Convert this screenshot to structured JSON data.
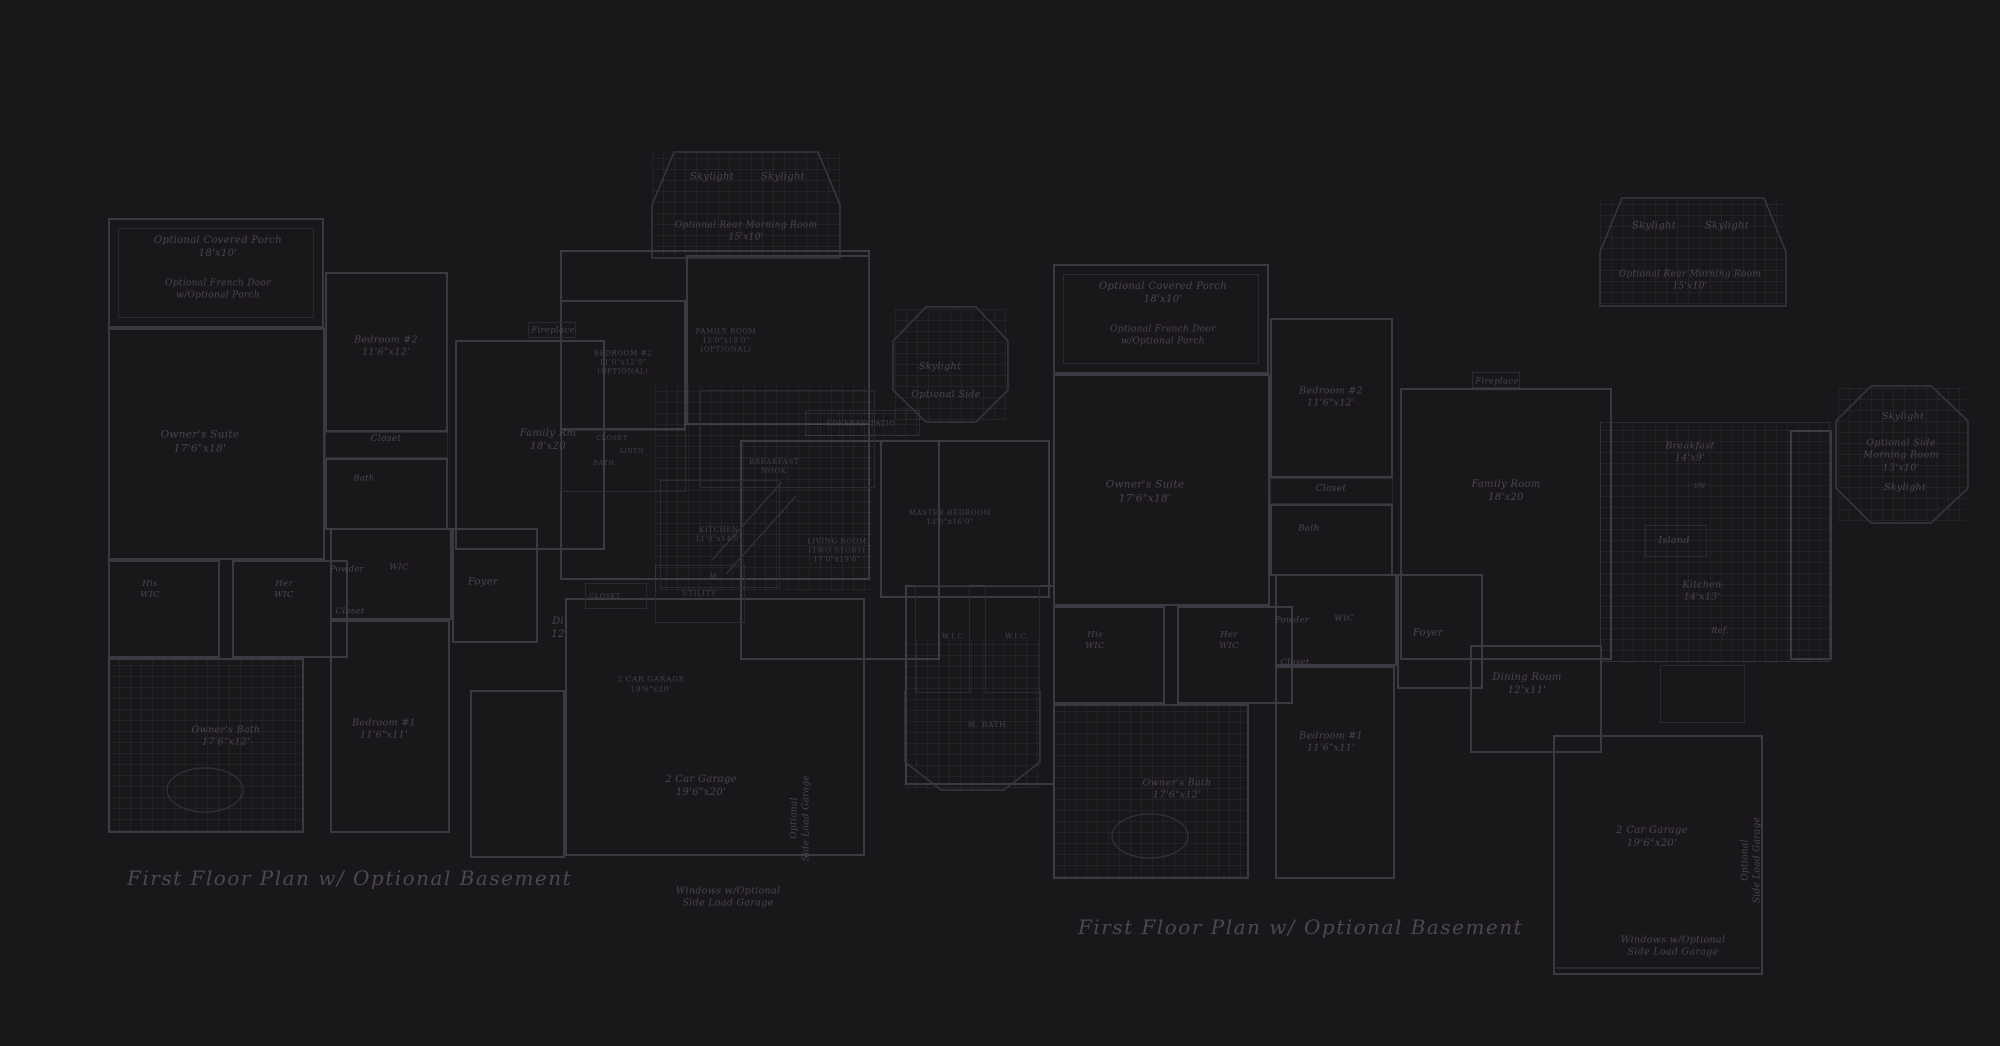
{
  "canvas": {
    "width": 2000,
    "height": 1046,
    "background": "#1a171a",
    "wall_color": "#3b3942",
    "faint_color": "#2b2931",
    "text_color": "#49464f",
    "title_color": "#4b4852"
  },
  "titles": {
    "left": "First Floor Plan  w/ Optional Basement",
    "right": "First Floor Plan  w/ Optional Basement"
  },
  "labels": [
    {
      "n": "label-optional-covered-porch-left",
      "l": [
        "Optional Covered Porch",
        "18'x10'"
      ],
      "x": 218,
      "y": 247,
      "fs": 10
    },
    {
      "n": "label-optional-french-door-left",
      "l": [
        "Optional French Door",
        "w/Optional Porch"
      ],
      "x": 218,
      "y": 290,
      "fs": 9
    },
    {
      "n": "label-bedroom2-left",
      "l": [
        "Bedroom #2",
        "11'6\"x12'"
      ],
      "x": 386,
      "y": 347,
      "fs": 9.5
    },
    {
      "n": "label-closet-bedroom2-left",
      "l": [
        "Closet"
      ],
      "x": 386,
      "y": 440,
      "fs": 9
    },
    {
      "n": "label-bath-left",
      "l": [
        "Bath"
      ],
      "x": 364,
      "y": 479,
      "fs": 8.5
    },
    {
      "n": "label-owners-suite-left",
      "l": [
        "Owner's Suite",
        "17'6\"x18'"
      ],
      "x": 200,
      "y": 442,
      "fs": 10.5
    },
    {
      "n": "label-his-wic-left",
      "l": [
        "His",
        "WIC"
      ],
      "x": 150,
      "y": 590,
      "fs": 8.5
    },
    {
      "n": "label-her-wic-left",
      "l": [
        "Her",
        "WIC"
      ],
      "x": 284,
      "y": 590,
      "fs": 8.5
    },
    {
      "n": "label-powder-left",
      "l": [
        "Powder"
      ],
      "x": 347,
      "y": 570,
      "fs": 8.5
    },
    {
      "n": "label-wic-left",
      "l": [
        "WIC"
      ],
      "x": 399,
      "y": 568,
      "fs": 8.5
    },
    {
      "n": "label-closet-hall-left",
      "l": [
        "Closet"
      ],
      "x": 350,
      "y": 612,
      "fs": 8.5
    },
    {
      "n": "label-foyer-left",
      "l": [
        "Foyer"
      ],
      "x": 483,
      "y": 582,
      "fs": 10
    },
    {
      "n": "label-dining-left",
      "l": [
        "Di",
        "12"
      ],
      "x": 558,
      "y": 628,
      "fs": 10
    },
    {
      "n": "label-bedroom1-left",
      "l": [
        "Bedroom #1",
        "11'6\"x11'"
      ],
      "x": 384,
      "y": 730,
      "fs": 9.5
    },
    {
      "n": "label-owners-bath-left",
      "l": [
        "Owner's Bath",
        "17'6\"x12'"
      ],
      "x": 226,
      "y": 737,
      "fs": 9.5
    },
    {
      "n": "label-skylight-1-left",
      "l": [
        "Skylight"
      ],
      "x": 712,
      "y": 177,
      "fs": 10
    },
    {
      "n": "label-skylight-2-left",
      "l": [
        "Skylight"
      ],
      "x": 783,
      "y": 177,
      "fs": 10
    },
    {
      "n": "label-optional-rear-morning-room-left",
      "l": [
        "Optional Rear Morning Room",
        "15'x10'"
      ],
      "x": 746,
      "y": 232,
      "fs": 9
    },
    {
      "n": "label-fireplace-left",
      "l": [
        "Fireplace"
      ],
      "x": 553,
      "y": 331,
      "fs": 8.5
    },
    {
      "n": "label-family-rm-left",
      "l": [
        "Family Rm",
        "18'x20"
      ],
      "x": 548,
      "y": 440,
      "fs": 10
    },
    {
      "n": "label-skylight-side-left",
      "l": [
        "Skylight"
      ],
      "x": 940,
      "y": 367,
      "fs": 9.5
    },
    {
      "n": "label-optional-side-left",
      "l": [
        "Optional Side"
      ],
      "x": 946,
      "y": 395,
      "fs": 9.5
    },
    {
      "n": "label-2-car-garage-left",
      "l": [
        "2 Car Garage",
        "19'6\"x20'"
      ],
      "x": 701,
      "y": 786,
      "fs": 10
    },
    {
      "n": "label-optional-side-load-garage-left",
      "l": [
        "Optional",
        "Side Load Garage"
      ],
      "x": 801,
      "y": 818,
      "fs": 9,
      "rot": -90
    },
    {
      "n": "label-windows-optional-side-load-left",
      "l": [
        "Windows w/Optional",
        "Side Load Garage"
      ],
      "x": 728,
      "y": 898,
      "fs": 9.5
    },
    {
      "n": "label-washer-left",
      "l": [
        "W"
      ],
      "x": 714,
      "y": 577,
      "fs": 7,
      "st": "c"
    },
    {
      "n": "label-caps-bedroom-center",
      "l": [
        "BEDROOM #2",
        "11'0\"x12'0\"",
        "(OPTIONAL)"
      ],
      "x": 623,
      "y": 363,
      "fs": 7,
      "st": "c"
    },
    {
      "n": "label-caps-family-room-center",
      "l": [
        "FAMILY ROOM",
        "15'0\"x18'0\"",
        "(OPTIONAL)"
      ],
      "x": 726,
      "y": 341,
      "fs": 7,
      "st": "c"
    },
    {
      "n": "label-caps-closet-center",
      "l": [
        "CLOSET"
      ],
      "x": 612,
      "y": 438,
      "fs": 6.5,
      "st": "c"
    },
    {
      "n": "label-caps-linen-center",
      "l": [
        "LINEN"
      ],
      "x": 632,
      "y": 452,
      "fs": 6,
      "st": "c"
    },
    {
      "n": "label-caps-bath-center",
      "l": [
        "BATH"
      ],
      "x": 604,
      "y": 463,
      "fs": 6.5,
      "st": "c"
    },
    {
      "n": "label-caps-breakfast-nook-center",
      "l": [
        "BREAKFAST",
        "NOOK"
      ],
      "x": 774,
      "y": 467,
      "fs": 7,
      "st": "c"
    },
    {
      "n": "label-caps-kitchen-center",
      "l": [
        "KITCHEN",
        "11'0\"x14'0\""
      ],
      "x": 719,
      "y": 535,
      "fs": 7,
      "st": "c"
    },
    {
      "n": "label-caps-living-room-center",
      "l": [
        "LIVING ROOM",
        "(TWO STORY)",
        "17'0\"x19'0\""
      ],
      "x": 837,
      "y": 551,
      "fs": 7,
      "st": "c"
    },
    {
      "n": "label-caps-master-bedroom-center",
      "l": [
        "MASTER BEDROOM",
        "13'0\"x16'0\""
      ],
      "x": 950,
      "y": 518,
      "fs": 7,
      "st": "c"
    },
    {
      "n": "label-caps-covered-patio-center",
      "l": [
        "COVERED PATIO"
      ],
      "x": 861,
      "y": 424,
      "fs": 7,
      "st": "c"
    },
    {
      "n": "label-caps-utility-center",
      "l": [
        "UTILITY"
      ],
      "x": 699,
      "y": 594,
      "fs": 7,
      "st": "c"
    },
    {
      "n": "label-caps-closet2-center",
      "l": [
        "CLOSET"
      ],
      "x": 605,
      "y": 596,
      "fs": 6.5,
      "st": "c"
    },
    {
      "n": "label-caps-2-car-garage-center",
      "l": [
        "2 CAR GARAGE",
        "19'6\"x20'"
      ],
      "x": 651,
      "y": 684,
      "fs": 7.5,
      "st": "c"
    },
    {
      "n": "label-wic-a-center",
      "l": [
        "W.I.C."
      ],
      "x": 954,
      "y": 637,
      "fs": 7,
      "st": "c"
    },
    {
      "n": "label-wic-b-center",
      "l": [
        "W.I.C."
      ],
      "x": 1017,
      "y": 637,
      "fs": 7,
      "st": "c"
    },
    {
      "n": "label-caps-m-bath-center",
      "l": [
        "M. BATH"
      ],
      "x": 987,
      "y": 725,
      "fs": 7.5,
      "st": "c"
    },
    {
      "n": "label-optional-covered-porch-right",
      "l": [
        "Optional Covered Porch",
        "18'x10'"
      ],
      "x": 1163,
      "y": 293,
      "fs": 10
    },
    {
      "n": "label-optional-french-door-right",
      "l": [
        "Optional French Door",
        "w/Optional Porch"
      ],
      "x": 1163,
      "y": 336,
      "fs": 9
    },
    {
      "n": "label-bedroom2-right",
      "l": [
        "Bedroom #2",
        "11'6\"x12'"
      ],
      "x": 1331,
      "y": 398,
      "fs": 9.5
    },
    {
      "n": "label-closet-bedroom2-right",
      "l": [
        "Closet"
      ],
      "x": 1331,
      "y": 490,
      "fs": 9
    },
    {
      "n": "label-bath-right",
      "l": [
        "Bath"
      ],
      "x": 1309,
      "y": 529,
      "fs": 8.5
    },
    {
      "n": "label-owners-suite-right",
      "l": [
        "Owner's Suite",
        "17'6\"x18'"
      ],
      "x": 1145,
      "y": 492,
      "fs": 10.5
    },
    {
      "n": "label-his-wic-right",
      "l": [
        "His",
        "WIC"
      ],
      "x": 1095,
      "y": 641,
      "fs": 8.5
    },
    {
      "n": "label-her-wic-right",
      "l": [
        "Her",
        "WIC"
      ],
      "x": 1229,
      "y": 641,
      "fs": 8.5
    },
    {
      "n": "label-powder-right",
      "l": [
        "Powder"
      ],
      "x": 1292,
      "y": 621,
      "fs": 8.5
    },
    {
      "n": "label-wic-right",
      "l": [
        "WIC"
      ],
      "x": 1344,
      "y": 619,
      "fs": 8.5
    },
    {
      "n": "label-closet-hall-right",
      "l": [
        "Closet"
      ],
      "x": 1295,
      "y": 663,
      "fs": 8.5
    },
    {
      "n": "label-foyer-right",
      "l": [
        "Foyer"
      ],
      "x": 1428,
      "y": 633,
      "fs": 10
    },
    {
      "n": "label-dining-room-right",
      "l": [
        "Dining Room",
        "12'x11'"
      ],
      "x": 1527,
      "y": 684,
      "fs": 10
    },
    {
      "n": "label-bedroom1-right",
      "l": [
        "Bedroom #1",
        "11'6\"x11'"
      ],
      "x": 1331,
      "y": 743,
      "fs": 9.5
    },
    {
      "n": "label-owners-bath-right",
      "l": [
        "Owner's Bath",
        "17'6\"x12'"
      ],
      "x": 1177,
      "y": 790,
      "fs": 9.5
    },
    {
      "n": "label-skylight-1-right",
      "l": [
        "Skylight"
      ],
      "x": 1654,
      "y": 226,
      "fs": 10
    },
    {
      "n": "label-skylight-2-right",
      "l": [
        "Skylight"
      ],
      "x": 1727,
      "y": 226,
      "fs": 10
    },
    {
      "n": "label-optional-rear-morning-room-right",
      "l": [
        "Optional Rear Morning Room",
        "15'x10'"
      ],
      "x": 1690,
      "y": 281,
      "fs": 9
    },
    {
      "n": "label-fireplace-right",
      "l": [
        "Fireplace"
      ],
      "x": 1497,
      "y": 382,
      "fs": 8.5
    },
    {
      "n": "label-family-room-right",
      "l": [
        "Family Room",
        "18'x20"
      ],
      "x": 1506,
      "y": 491,
      "fs": 10
    },
    {
      "n": "label-breakfast-right",
      "l": [
        "Breakfast",
        "14'x9'"
      ],
      "x": 1690,
      "y": 453,
      "fs": 9.5
    },
    {
      "n": "label-dw-right",
      "l": [
        "DW"
      ],
      "x": 1700,
      "y": 487,
      "fs": 6,
      "st": "c"
    },
    {
      "n": "label-island-right",
      "l": [
        "Island"
      ],
      "x": 1674,
      "y": 541,
      "fs": 9.5
    },
    {
      "n": "label-kitchen-right",
      "l": [
        "Kitchen",
        "14'x13'"
      ],
      "x": 1702,
      "y": 592,
      "fs": 9.5
    },
    {
      "n": "label-ref-right",
      "l": [
        "Ref."
      ],
      "x": 1720,
      "y": 631,
      "fs": 8
    },
    {
      "n": "label-skylight-side-top-right",
      "l": [
        "Skylight"
      ],
      "x": 1903,
      "y": 417,
      "fs": 9.5
    },
    {
      "n": "label-optional-side-morning-room-right",
      "l": [
        "Optional Side",
        "Morning Room",
        "13'x10'"
      ],
      "x": 1901,
      "y": 456,
      "fs": 9.5
    },
    {
      "n": "label-skylight-side-bottom-right",
      "l": [
        "Skylight"
      ],
      "x": 1905,
      "y": 488,
      "fs": 9.5
    },
    {
      "n": "label-2-car-garage-right",
      "l": [
        "2 Car Garage",
        "19'6\"x20'"
      ],
      "x": 1652,
      "y": 837,
      "fs": 10
    },
    {
      "n": "label-optional-side-load-garage-right",
      "l": [
        "Optional",
        "Side Load Garage"
      ],
      "x": 1752,
      "y": 860,
      "fs": 9,
      "rot": -90
    },
    {
      "n": "label-windows-optional-side-load-right",
      "l": [
        "Windows w/Optional",
        "Side Load Garage"
      ],
      "x": 1673,
      "y": 947,
      "fs": 9.5
    }
  ],
  "walls": [
    [
      108,
      218,
      216,
      110
    ],
    [
      108,
      328,
      217,
      232
    ],
    [
      325,
      272,
      123,
      160
    ],
    [
      325,
      458,
      123,
      72
    ],
    [
      108,
      560,
      112,
      98
    ],
    [
      232,
      560,
      116,
      98
    ],
    [
      108,
      658,
      196,
      175
    ],
    [
      330,
      620,
      120,
      213
    ],
    [
      330,
      528,
      122,
      92
    ],
    [
      452,
      528,
      86,
      115
    ],
    [
      455,
      340,
      150,
      210
    ],
    [
      560,
      250,
      310,
      330
    ],
    [
      686,
      255,
      184,
      170
    ],
    [
      560,
      300,
      126,
      130
    ],
    [
      740,
      440,
      200,
      220
    ],
    [
      880,
      440,
      170,
      158
    ],
    [
      565,
      598,
      300,
      258
    ],
    [
      470,
      690,
      95,
      168
    ],
    [
      905,
      585,
      150,
      200
    ],
    [
      1053,
      264,
      216,
      110
    ],
    [
      1053,
      374,
      217,
      232
    ],
    [
      1270,
      318,
      123,
      160
    ],
    [
      1270,
      504,
      123,
      72
    ],
    [
      1053,
      606,
      112,
      98
    ],
    [
      1177,
      606,
      116,
      98
    ],
    [
      1053,
      704,
      196,
      175
    ],
    [
      1275,
      666,
      120,
      213
    ],
    [
      1275,
      574,
      122,
      92
    ],
    [
      1397,
      574,
      86,
      115
    ],
    [
      1400,
      388,
      212,
      272
    ],
    [
      1470,
      645,
      132,
      108
    ],
    [
      1553,
      735,
      210,
      240
    ],
    [
      1790,
      430,
      42,
      230
    ]
  ],
  "faint_walls": [
    [
      118,
      228,
      196,
      90
    ],
    [
      325,
      432,
      123,
      26
    ],
    [
      528,
      322,
      48,
      16
    ],
    [
      560,
      430,
      126,
      62
    ],
    [
      805,
      410,
      115,
      26
    ],
    [
      655,
      565,
      90,
      58
    ],
    [
      585,
      583,
      62,
      26
    ],
    [
      915,
      585,
      55,
      108
    ],
    [
      985,
      585,
      55,
      108
    ],
    [
      660,
      480,
      120,
      108
    ],
    [
      700,
      390,
      175,
      98
    ],
    [
      1063,
      274,
      196,
      90
    ],
    [
      1270,
      478,
      123,
      26
    ],
    [
      1472,
      372,
      48,
      16
    ],
    [
      1645,
      525,
      62,
      32
    ],
    [
      1660,
      665,
      85,
      58
    ],
    [
      1600,
      422,
      230,
      240
    ]
  ],
  "grids": [
    [
      652,
      152,
      188,
      106
    ],
    [
      108,
      660,
      194,
      171
    ],
    [
      655,
      385,
      218,
      205
    ],
    [
      895,
      309,
      111,
      111
    ],
    [
      806,
      412,
      112,
      24
    ],
    [
      905,
      640,
      135,
      148
    ],
    [
      1600,
      200,
      184,
      104
    ],
    [
      1600,
      422,
      230,
      240
    ],
    [
      1053,
      706,
      194,
      171
    ],
    [
      1838,
      388,
      128,
      133
    ]
  ],
  "polys": [
    "652,205 674,152 818,152 840,205 840,258 652,258 652,205",
    "893,341 926,307 976,307 1008,341 1008,390 976,422 926,422 893,390 893,341",
    "905,690 905,762 941,790 1004,790 1040,762 1040,690",
    "1600,252 1622,198 1764,198 1786,252 1786,306 1600,306 1600,252",
    "1836,421 1871,386 1931,386 1968,421 1968,488 1931,523 1871,523 1836,488 1836,421"
  ],
  "lines": [
    [
      712,
      560,
      782,
      482
    ],
    [
      726,
      574,
      796,
      496
    ],
    [
      1553,
      968,
      1760,
      968
    ]
  ],
  "ellipses": [
    [
      205,
      790,
      38,
      22
    ],
    [
      1150,
      836,
      38,
      22
    ]
  ]
}
